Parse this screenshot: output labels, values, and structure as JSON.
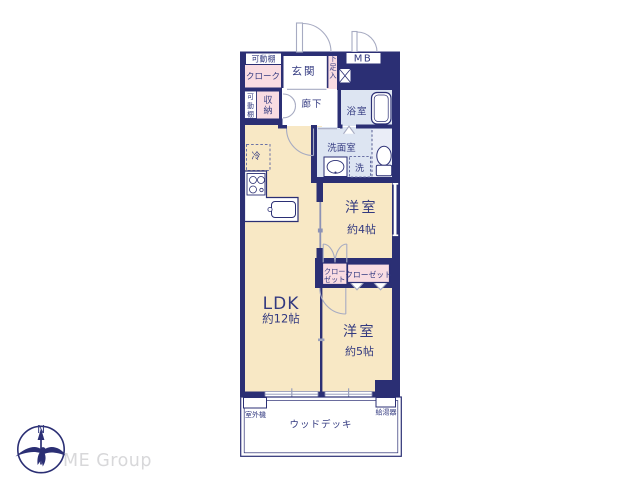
{
  "colors": {
    "wall_navy": "#2b2f74",
    "text_navy": "#333a80",
    "room_cream": "#f8e8c5",
    "closet_pink": "#f9dce2",
    "wet_area_blue": "#dde5f2",
    "toilet_blue": "#eaedf7",
    "brand_gray": "#d8d8da"
  },
  "plan": {
    "movable_shelf_top": "可動棚",
    "cloak": "クローク",
    "entrance": "玄関",
    "shoe_cabinet": "下足入",
    "meter_box": "MB",
    "movable_shelf_side": "可動棚",
    "storage": "収納",
    "hallway": "廊下",
    "bathroom": "浴室",
    "washroom": "洗面室",
    "washer": "洗",
    "fridge": "冷",
    "bedroom_4": {
      "name": "洋室",
      "size": "約4帖"
    },
    "closet_small_line1": "クロー",
    "closet_small_line2": "ゼット",
    "closet_large": "クローゼット",
    "ldk": {
      "name": "LDK",
      "size": "約12帖"
    },
    "bedroom_5": {
      "name": "洋室",
      "size": "約5帖"
    },
    "outdoor_unit": "室外機",
    "water_heater": "給湯器",
    "wood_deck": "ウッドデッキ"
  },
  "footer": {
    "compass_north": "N",
    "brand": "ME Group"
  }
}
